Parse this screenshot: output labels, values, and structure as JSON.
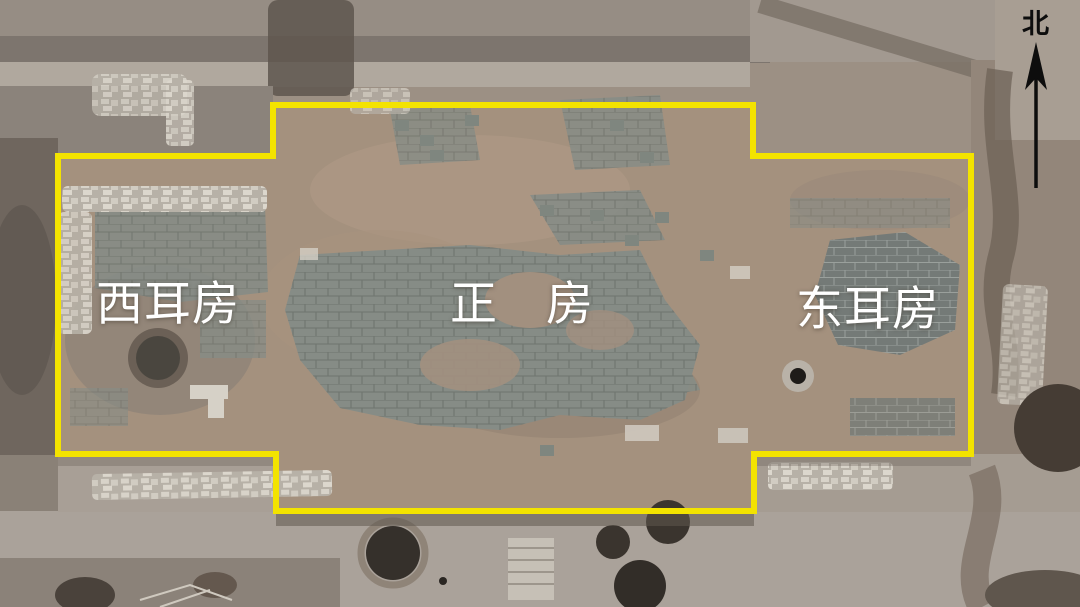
{
  "annotations": {
    "outline_color": "#F3E300",
    "label_color": "#FFFFFF",
    "north_color": "#0D0D0D",
    "labels": {
      "west_room": "西耳房",
      "main_room": "正　房",
      "east_room": "东耳房",
      "north_marker": "北"
    }
  }
}
